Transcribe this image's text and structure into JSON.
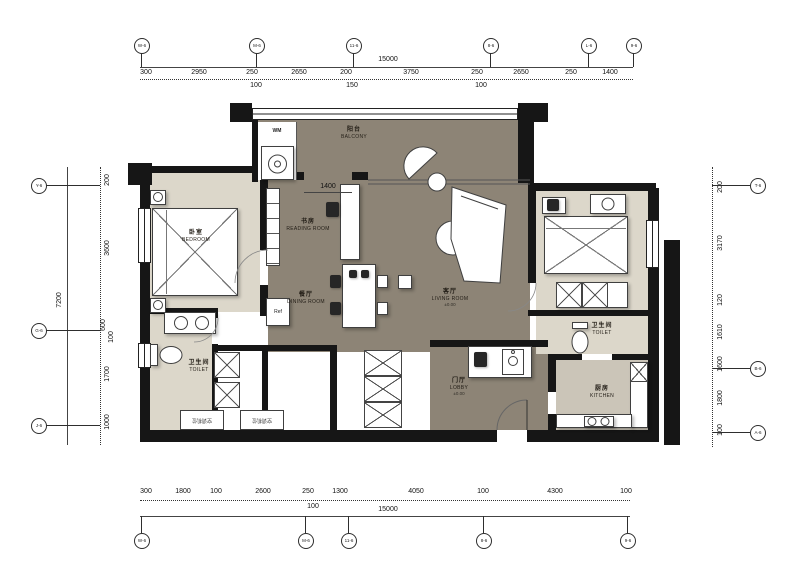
{
  "dims": {
    "top": {
      "total": "15000",
      "segments": [
        "300",
        "2950",
        "250",
        "2650",
        "200",
        "3750",
        "250",
        "2650",
        "250",
        "1400"
      ],
      "subs": [
        "100",
        "150",
        "100"
      ]
    },
    "bottom": {
      "total": "15000",
      "segments": [
        "300",
        "1800",
        "100",
        "2600",
        "250",
        "1300",
        "4050",
        "100",
        "4300",
        "100"
      ],
      "subs": [
        "100"
      ]
    },
    "left": {
      "total": "7200",
      "segments": [
        "200",
        "3600",
        "600",
        "100",
        "1700",
        "1000"
      ]
    },
    "right": {
      "segments": [
        "200",
        "3170",
        "120",
        "1610",
        "1600",
        "1800",
        "100"
      ]
    },
    "interior": {
      "reading_niche": "1400"
    }
  },
  "axes": {
    "top": [
      "W-6",
      "M-6",
      "11-6",
      "8-6",
      "L-6",
      "9-6"
    ],
    "bottom": [
      "W-6",
      "M-6",
      "11-6",
      "8-6",
      "9-6"
    ],
    "left": [
      "Y-6",
      "G-6",
      "J-6"
    ],
    "right": [
      "T-6",
      "B-6",
      "A-6"
    ]
  },
  "rooms": {
    "bedroom": {
      "zh": "卧室",
      "en": "BEDROOM"
    },
    "reading": {
      "zh": "书房",
      "en": "READING ROOM"
    },
    "dining": {
      "zh": "餐厅",
      "en": "DINING ROOM"
    },
    "living": {
      "zh": "客厅",
      "en": "LIVING ROOM",
      "level": "±0.00"
    },
    "toilet_left": {
      "zh": "卫生间",
      "en": "TOILET"
    },
    "toilet_right": {
      "zh": "卫生间",
      "en": "TOILET"
    },
    "lobby": {
      "zh": "门厅",
      "en": "LOBBY",
      "level": "±0.00"
    },
    "kitchen": {
      "zh": "厨房",
      "en": "KITCHEN"
    },
    "balcony": {
      "zh": "阳台",
      "en": "BALCONY"
    }
  },
  "fixtures": {
    "washer": "WM",
    "fridge": "Ref",
    "ac": "空调机位"
  },
  "colors": {
    "wall": "#161616",
    "public_floor": "#8d8476",
    "private_floor": "#dcd7ca",
    "kitchen_floor": "#cbc5b8"
  }
}
